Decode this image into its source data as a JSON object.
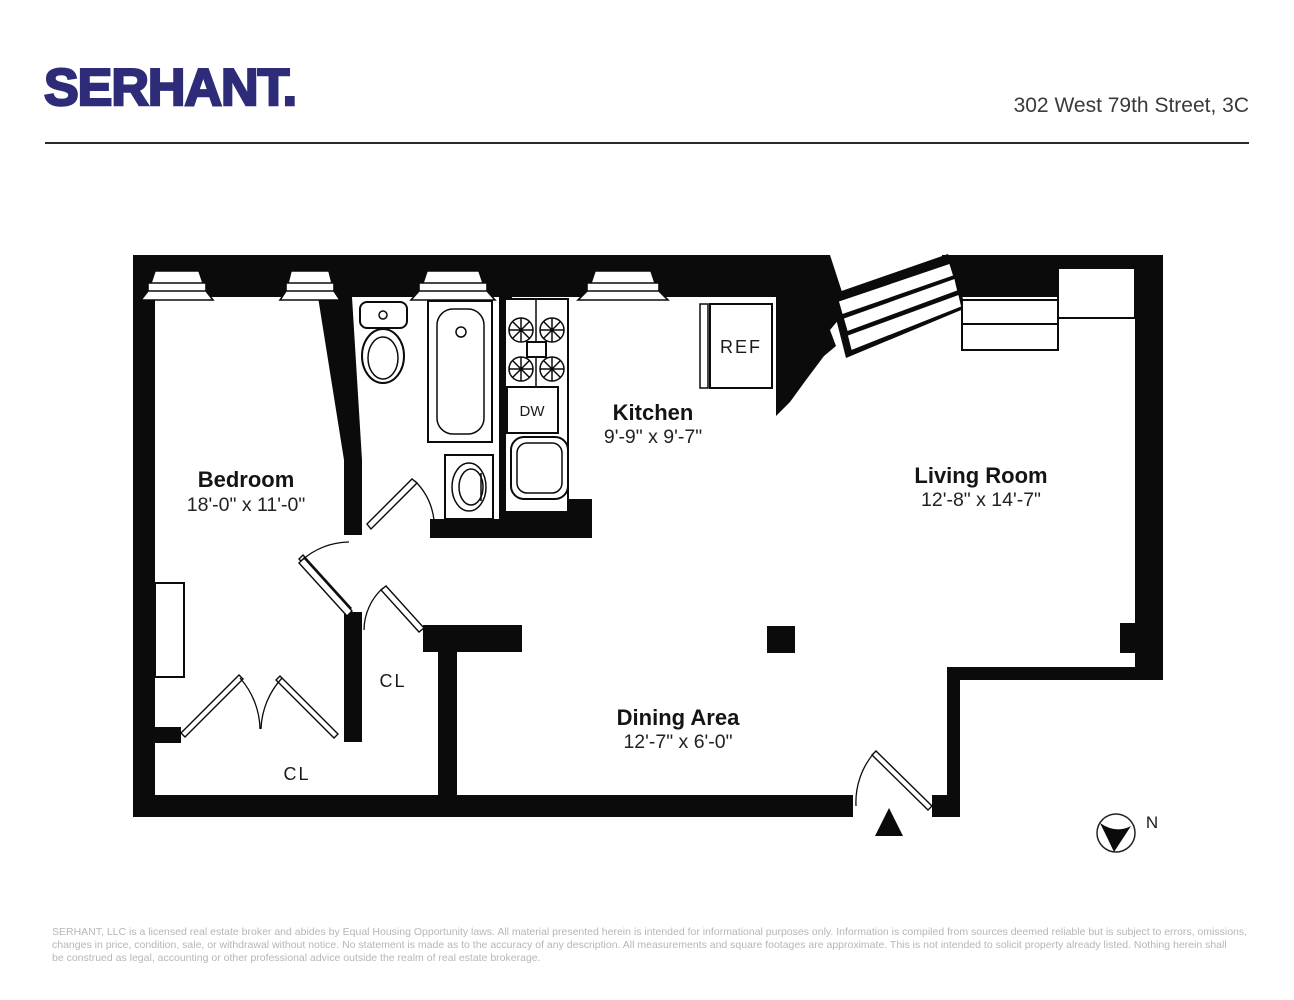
{
  "header": {
    "logo": "SERHANT.",
    "address": "302 West 79th Street, 3C",
    "brand_color": "#2e2c78"
  },
  "floorplan": {
    "rooms": [
      {
        "name": "Bedroom",
        "dimensions": "18'-0\" x 11'-0\""
      },
      {
        "name": "Kitchen",
        "dimensions": "9'-9\" x 9'-7\""
      },
      {
        "name": "Living Room",
        "dimensions": "12'-8\" x 14'-7\""
      },
      {
        "name": "Dining Area",
        "dimensions": "12'-7\" x 6'-0\""
      }
    ],
    "closets": [
      "CL",
      "CL"
    ],
    "fixtures": {
      "refrigerator": "REF",
      "dishwasher": "DW"
    },
    "compass": {
      "label": "N"
    }
  },
  "footer": {
    "disclaimer_lines": [
      "SERHANT, LLC is a licensed real estate broker and abides by Equal Housing Opportunity laws. All material presented herein is intended for informational purposes only. Information is compiled from sources deemed reliable but is subject to errors, omissions,",
      "changes in price, condition, sale, or withdrawal without notice. No statement is made as to the accuracy of any description. All measurements and square footages are approximate. This is not intended to solicit property already listed. Nothing herein shall",
      "be construed as legal, accounting or other professional advice outside the realm of real estate brokerage."
    ]
  }
}
